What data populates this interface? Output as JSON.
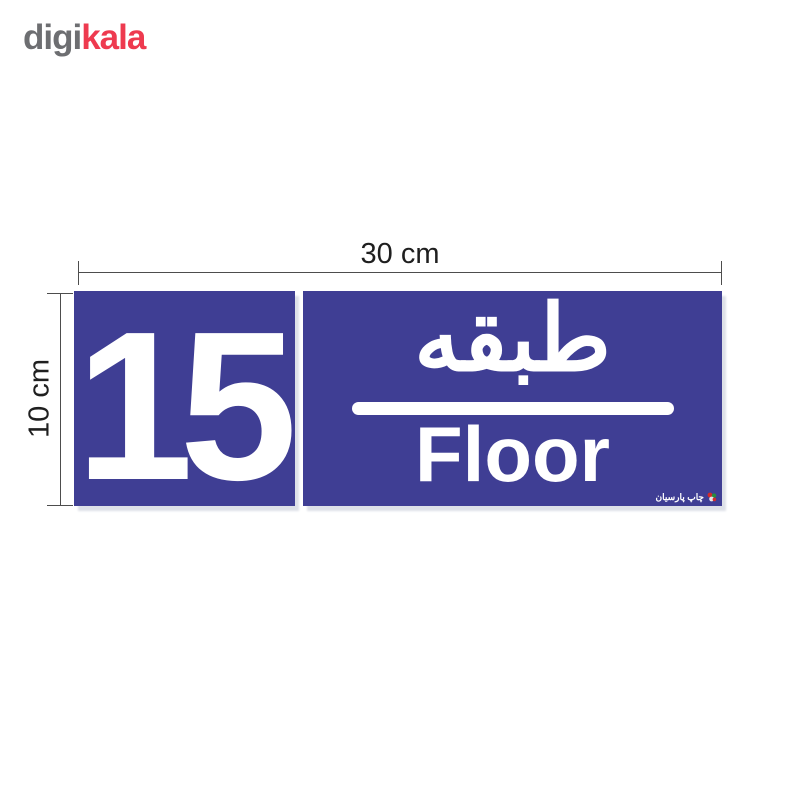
{
  "page": {
    "background_color": "#ffffff",
    "description_colors": {
      "sign_blue": "#3f3e94",
      "sign_text_white": "#ffffff",
      "logo_gray": "#6d6e71",
      "logo_red": "#ee3a4f",
      "dimension_line_gray": "#4d4d4d"
    }
  },
  "logo": {
    "part1": "digi",
    "part2": "kala"
  },
  "dimensions": {
    "width_label": "30 cm",
    "height_label": "10 cm"
  },
  "sign": {
    "panel_color": "#3f3e94",
    "left_panel": {
      "number": "15"
    },
    "right_panel": {
      "persian_label": "طبقه",
      "english_label": "Floor"
    },
    "watermark": {
      "text": "چاپ پارسیان",
      "icon": "parsian-print-logo-icon"
    }
  }
}
